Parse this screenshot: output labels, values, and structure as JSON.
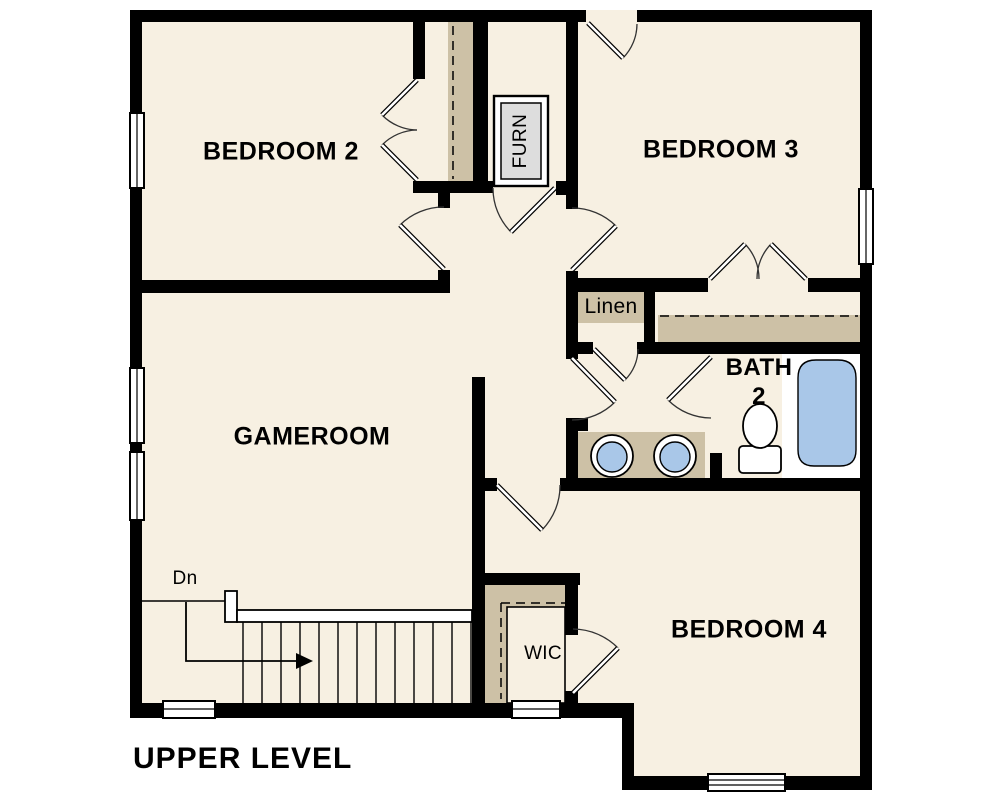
{
  "plan": {
    "title": "UPPER LEVEL",
    "rooms": {
      "bedroom2": {
        "label": "BEDROOM 2"
      },
      "bedroom3": {
        "label": "BEDROOM 3"
      },
      "gameroom": {
        "label": "GAMEROOM"
      },
      "bedroom4": {
        "label": "BEDROOM 4"
      },
      "bath2": {
        "label_line1": "BATH",
        "label_line2": "2"
      }
    },
    "closets": {
      "linen": {
        "label": "Linen"
      },
      "wic": {
        "label": "WIC"
      },
      "furnace": {
        "label": "FURN"
      }
    },
    "stairs": {
      "down_label": "Dn"
    },
    "fixtures": [
      "bathtub-icon",
      "toilet-icon",
      "double-sink-icon"
    ],
    "colors": {
      "floor": "#f7f0e2",
      "wall": "#000000",
      "casework": "#cdc1a6",
      "fixture_blue": "#a9c7e8",
      "furnace_gray": "#dddddd",
      "paper": "#ffffff"
    }
  }
}
